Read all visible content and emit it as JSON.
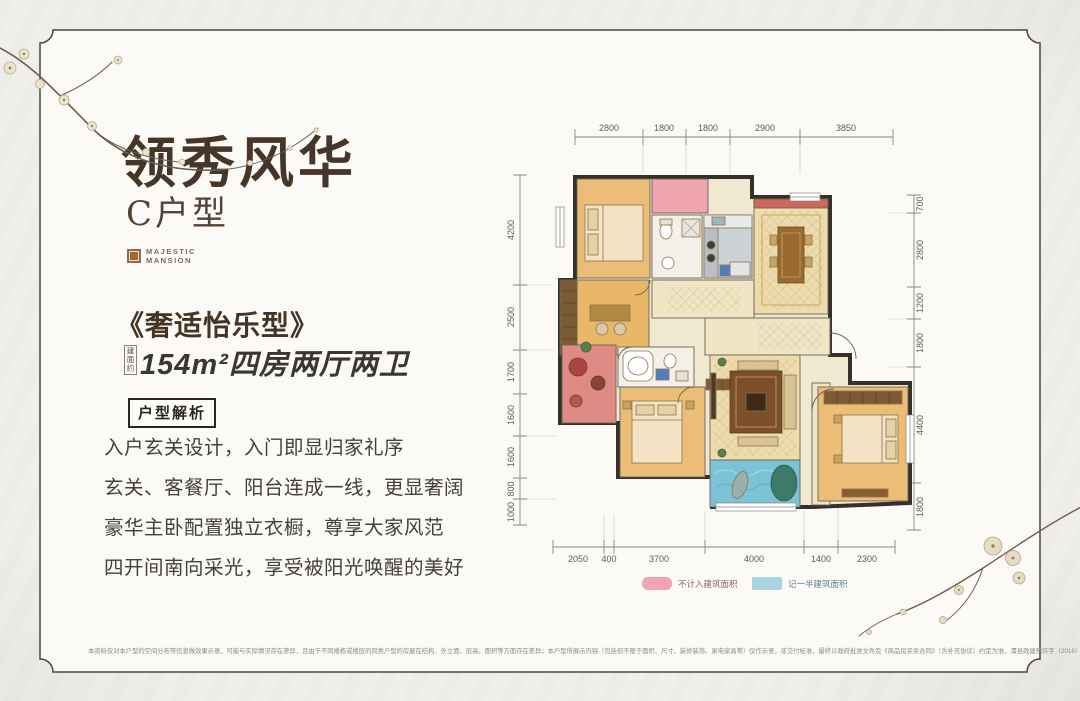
{
  "header": {
    "title": "领秀风华",
    "subtitle": "C户型",
    "brand_line1": "MAJESTIC",
    "brand_line2": "MANSION"
  },
  "intro": {
    "style_name": "《奢适怡乐型》",
    "area_prefix": "建面约",
    "area_text": "154m²四房两厅两卫",
    "analysis_badge": "户型解析",
    "features": [
      "入户玄关设计，入门即显归家礼序",
      "玄关、客餐厅、阳台连成一线，更显奢阔",
      "豪华主卧配置独立衣橱，尊享大家风范",
      "四开间南向采光，享受被阳光唤醒的美好"
    ]
  },
  "floorplan": {
    "dims_top": [
      "2800",
      "1800",
      "1800",
      "2900",
      "3850"
    ],
    "dims_left": [
      "4200",
      "2500",
      "1700",
      "1600",
      "1600",
      "800",
      "1000"
    ],
    "dims_right": [
      "700",
      "2800",
      "1200",
      "1800",
      "4400",
      "1800"
    ],
    "dims_bottom": [
      "2050",
      "400",
      "3700",
      "4000",
      "1400",
      "2300"
    ],
    "legend": [
      {
        "color": "#f0a5b1",
        "label": "不计入建筑面积"
      },
      {
        "color": "#a9d4e4",
        "label": "记一半建筑面积"
      }
    ]
  },
  "disclaimer": "本资料仅对本户型的空间分布等信息做效果示意，可能与实际情况存在差异，且由于不同楼栋或楼层的同类户型的房屋在结构、外立面、层高、面积等方面存在差异；本户型所展示内容（包括但不限于面积、尺寸、装修装饰、家电家具等）仅作示意，非交付标准，最终以政府批准文件及《商品房买卖合同》（含补充协议）约定为准。潭县政建预许字（2018）第19号"
}
